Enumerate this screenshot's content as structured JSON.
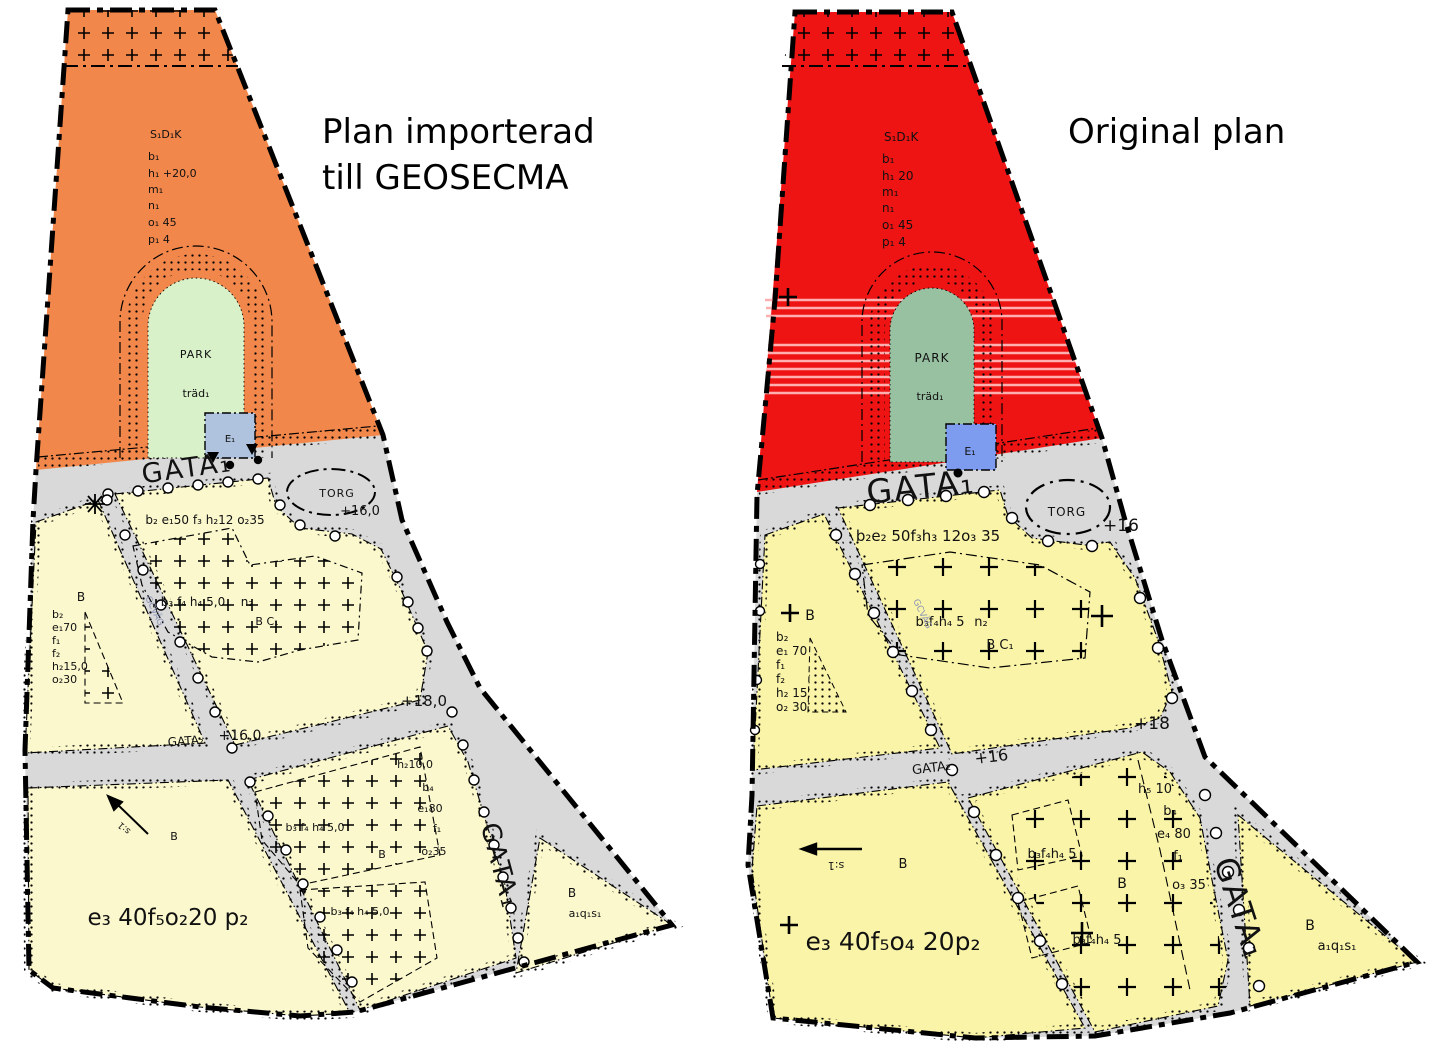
{
  "left": {
    "title_line1": "Plan importerad",
    "title_line2": "till GEOSECMA",
    "s_code": "S₁D₁K",
    "s_b": "b₁",
    "s_h": "h₁ +20,0",
    "s_m": "m₁",
    "s_n": "n₁",
    "s_o": "o₁ 45",
    "s_p": "p₁ 4",
    "park": "PARK",
    "trad": "träd₁",
    "e1": "E₁",
    "gata1": "GATA₁",
    "torg": "TORG",
    "torg_level": "+16,0",
    "block1_row": "b₂ e₁50  f₃ h₂12  o₂35",
    "b_upper": "B",
    "stack": [
      "b₂",
      "e₁70",
      "f₁",
      "f₂",
      "h₂15,0",
      "o₂30"
    ],
    "bfh_mid": "b₃ f₄ h₄ 5,0",
    "n2": "n₂",
    "bc1": "B C₁",
    "gata2": "GATA₂",
    "gata2_level": "+16,0",
    "junction_level": "+18,0",
    "h_col": [
      "h₂10,0",
      "b₄",
      "e₁80",
      "f₁",
      "o₂35"
    ],
    "bfh_upper": "b₃ f₄ h₄ 5,0",
    "b_mid": "B",
    "bfh_lower": "b₃ f₄ h₄ 5,0",
    "b_lower": "B",
    "formula": "e₃ 40f₅o₂20 p₂",
    "s_marker": "s:1",
    "gata_vert": "GATA₁",
    "b_corner": "B",
    "aqs": "a₁q₁s₁",
    "gc": "GCVÄG"
  },
  "right": {
    "title": "Original plan",
    "s_code": "S₁D₁K",
    "s_b": "b₁",
    "s_h": "h₁ 20",
    "s_m": "m₁",
    "s_n": "n₁",
    "s_o": "o₁ 45",
    "s_p": "p₁ 4",
    "park": "PARK",
    "trad": "träd₁",
    "e1": "E₁",
    "gata1": "GATA₁",
    "torg": "TORG",
    "torg_level": "+16",
    "block1_row": "b₂e₂ 50f₃h₃ 12o₃ 35",
    "b_upper": "B",
    "stack": [
      "b₂",
      "e₁ 70",
      "f₁",
      "f₂",
      "h₂ 15",
      "o₂ 30"
    ],
    "bfh_mid": "b₃f₄h₄ 5",
    "n2": "n₂",
    "bc1": "B C₁",
    "gata2": "GATA₂",
    "gata2_level": "+16",
    "junction_level": "+18",
    "h_col": [
      "h₅ 10",
      "b₄",
      "e₄ 80",
      "f₁",
      "o₃ 35"
    ],
    "bfh_upper": "b₃f₄h₄ 5",
    "b_mid": "B",
    "bfh_lower": "b₃f₄h₄ 5",
    "b_lower": "B",
    "formula": "e₃ 40f₅o₄ 20p₂",
    "s_marker": "s:1",
    "gata_vert": "GATA₁",
    "b_corner": "B",
    "aqs": "a₁q₁s₁",
    "gc": "GCVÄG"
  },
  "colors": {
    "left_zone": "#F2874B",
    "right_zone": "#EE1414",
    "left_park": "#D8F1C8",
    "right_park": "#98C1A2",
    "left_yellow": "#FBF8CD",
    "right_yellow": "#FAF4A8",
    "road_grey": "#D9D9D9",
    "left_e": "#AFC2DE",
    "right_e": "#7E9CEF",
    "right_torg_text": "#2E4FA5",
    "stripe_pink": "#FFAFAF"
  }
}
